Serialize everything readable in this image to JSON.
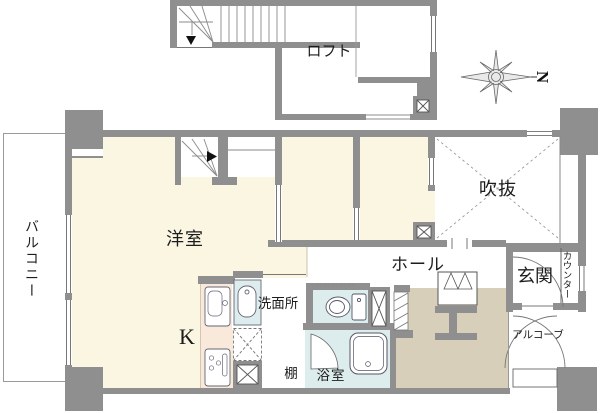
{
  "compass": {
    "north_label": "N"
  },
  "rooms": {
    "loft": "ロフト",
    "void": "吹抜",
    "western_room": "洋室",
    "kitchen": "K",
    "balcony": "バルコニー",
    "hall": "ホール",
    "entrance": "玄関",
    "counter": "カウンター",
    "alcove": "アルコーブ",
    "washroom": "洗面所",
    "shelf": "棚",
    "bathroom": "浴室"
  },
  "colors": {
    "wall": "#8f8f8f",
    "room_cream": "#faf6e2",
    "wet_area_blue": "#ddeded",
    "entrance_tan": "#d8cfba",
    "kitchen_pink": "#f9e9da"
  }
}
